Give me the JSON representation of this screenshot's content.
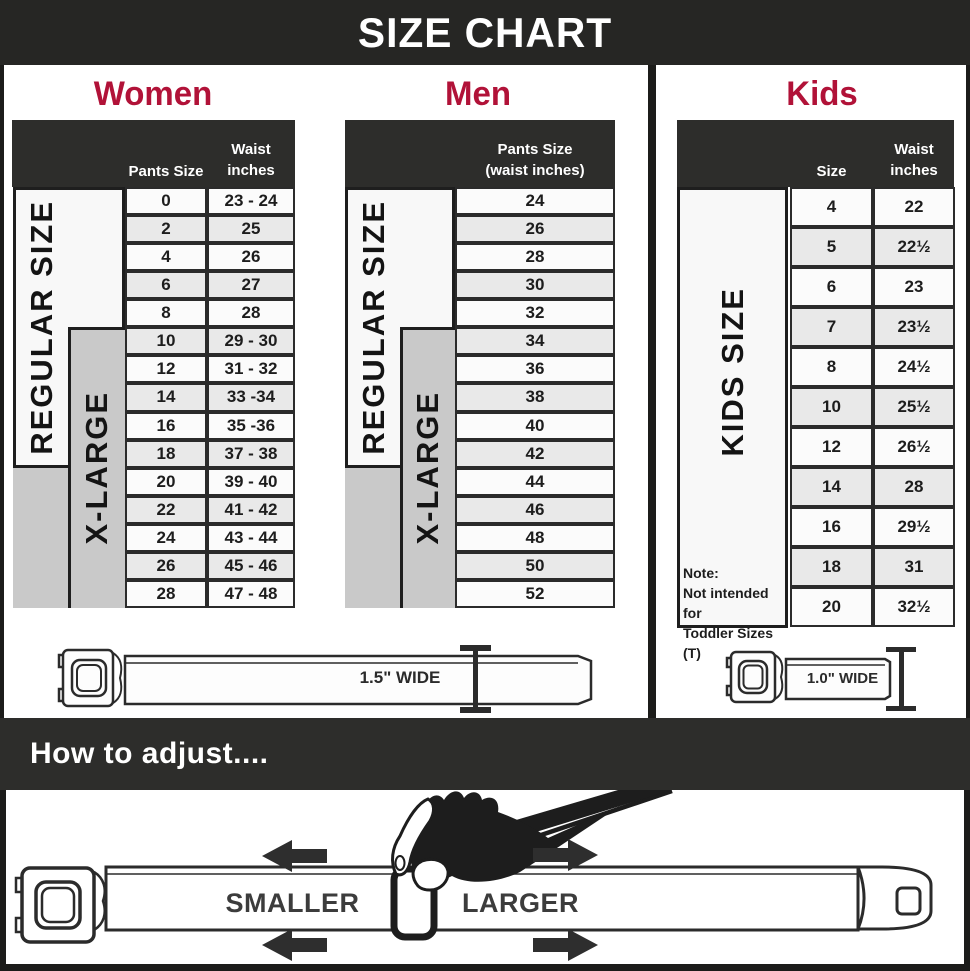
{
  "title": "SIZE CHART",
  "colors": {
    "accent": "#b11238",
    "header_dark": "#2d2d2b",
    "xlarge_gray": "#c9c9c9"
  },
  "women": {
    "header": "Women",
    "regular_label": "REGULAR SIZE",
    "xlarge_label": "X-LARGE",
    "col1": "Pants Size",
    "col2_line1": "Waist",
    "col2_line2": "inches"
  },
  "men": {
    "header": "Men",
    "regular_label": "REGULAR SIZE",
    "xlarge_label": "X-LARGE",
    "col_line1": "Pants Size",
    "col_line2": "(waist inches)"
  },
  "kids": {
    "header": "Kids",
    "side_label": "KIDS SIZE",
    "col1": "Size",
    "col2_line1": "Waist",
    "col2_line2": "inches",
    "note": {
      "line1": "Note:",
      "line2": "Not intended for",
      "line3": "Toddler Sizes (T)"
    }
  },
  "belts": {
    "adult_label": "1.5\" WIDE",
    "kids_label": "1.0\" WIDE"
  },
  "adjust": {
    "heading": "How to adjust....",
    "smaller": "SMALLER",
    "larger": "LARGER"
  },
  "chart_data": [
    {
      "type": "table",
      "title": "Women",
      "columns": [
        "Pants Size",
        "Waist inches"
      ],
      "rows": [
        [
          "0",
          "23 - 24"
        ],
        [
          "2",
          "25"
        ],
        [
          "4",
          "26"
        ],
        [
          "6",
          "27"
        ],
        [
          "8",
          "28"
        ],
        [
          "10",
          "29 - 30"
        ],
        [
          "12",
          "31 - 32"
        ],
        [
          "14",
          "33 -34"
        ],
        [
          "16",
          "35 -36"
        ],
        [
          "18",
          "37 - 38"
        ],
        [
          "20",
          "39 - 40"
        ],
        [
          "22",
          "41 - 42"
        ],
        [
          "24",
          "43 - 44"
        ],
        [
          "26",
          "45 - 46"
        ],
        [
          "28",
          "47 - 48"
        ]
      ]
    },
    {
      "type": "table",
      "title": "Men",
      "columns": [
        "Pants Size (waist inches)"
      ],
      "rows": [
        [
          "24"
        ],
        [
          "26"
        ],
        [
          "28"
        ],
        [
          "30"
        ],
        [
          "32"
        ],
        [
          "34"
        ],
        [
          "36"
        ],
        [
          "38"
        ],
        [
          "40"
        ],
        [
          "42"
        ],
        [
          "44"
        ],
        [
          "46"
        ],
        [
          "48"
        ],
        [
          "50"
        ],
        [
          "52"
        ]
      ]
    },
    {
      "type": "table",
      "title": "Kids",
      "columns": [
        "Size",
        "Waist inches"
      ],
      "rows": [
        [
          "4",
          "22"
        ],
        [
          "5",
          "22½"
        ],
        [
          "6",
          "23"
        ],
        [
          "7",
          "23½"
        ],
        [
          "8",
          "24½"
        ],
        [
          "10",
          "25½"
        ],
        [
          "12",
          "26½"
        ],
        [
          "14",
          "28"
        ],
        [
          "16",
          "29½"
        ],
        [
          "18",
          "31"
        ],
        [
          "20",
          "32½"
        ]
      ]
    }
  ]
}
